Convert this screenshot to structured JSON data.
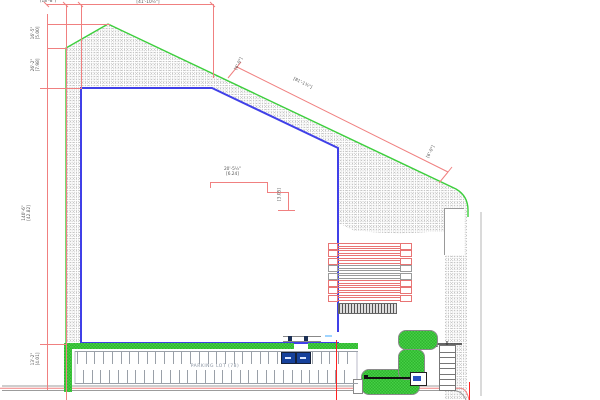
{
  "annotations": {
    "top_left": "(18'-8\")",
    "top_right": "[41'-10½\"]",
    "left_1a": "16'-5\"",
    "left_1b": "[5.00]",
    "left_2a": "26'-2\"",
    "left_2b": "[7.98]",
    "left_3a": "140'-6\"",
    "left_3b": "[42.82]",
    "left_4a": "13'-2\"",
    "left_4b": "[4.01]",
    "center_a": "20'-5½\"",
    "center_b": "[6.24]",
    "center_rot": "[3.05]",
    "diag_mid": "[81'-1¾\"]",
    "diag_end_left": "[6'-0\"]",
    "diag_end_right": "[6'-0\"]"
  },
  "parking": {
    "label": "PARKING LOT (78)",
    "stall_total": 78,
    "accessible_stalls": 2,
    "stall_rows": [
      {
        "count": 32,
        "x0": 77,
        "step": 8.7,
        "y": 351,
        "h": 13
      },
      {
        "count": 31,
        "x0": 83,
        "step": 8.7,
        "y": 370,
        "h": 13
      }
    ]
  },
  "docks": {
    "rows": [
      "red",
      "red",
      "red",
      "gray",
      "gray",
      "red",
      "red",
      "red"
    ]
  },
  "stairs": {
    "rungs": 7
  },
  "colors": {
    "dimension": "#f08080",
    "dimension_bright": "#ff2222",
    "boundary_green": "#3ccf3c",
    "grass_green": "#46cf46",
    "grass_dark": "#2fb52f",
    "building_blue": "#4040e8",
    "dock_red": "#e87474",
    "dock_gray": "#9a9a9a",
    "road_gray": "#9c9c9c",
    "hatch_dot": "#c6c6c6",
    "stall_blue": "#16419b",
    "text": "#555555"
  }
}
